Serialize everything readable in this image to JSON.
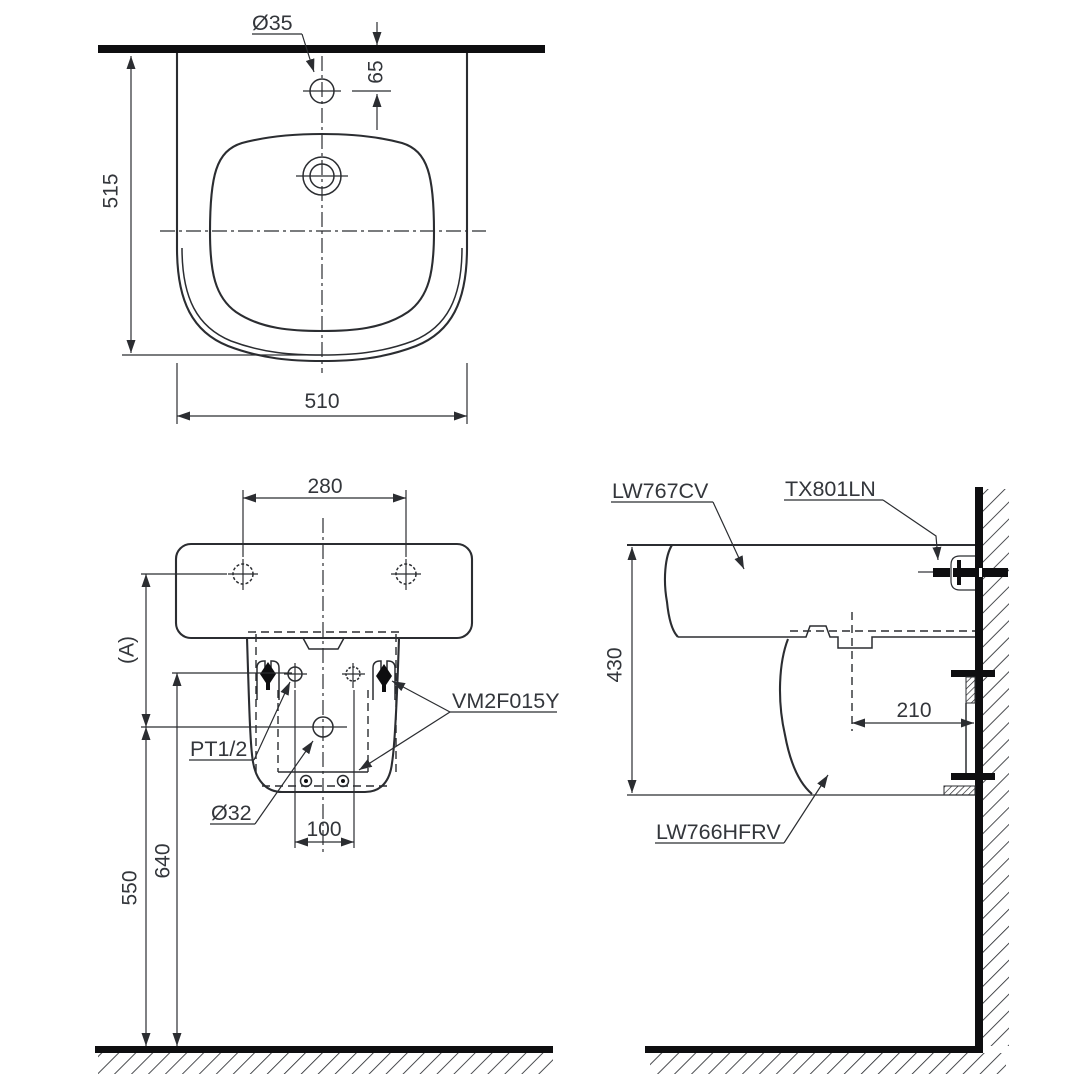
{
  "drawing": {
    "top_view": {
      "faucet_hole_dia": "Ø35",
      "hole_offset": "65",
      "depth": "515",
      "width": "510"
    },
    "front_view": {
      "bolt_spacing": "280",
      "ref_height": "(A)",
      "supply_thread": "PT1/2",
      "drain_dia": "Ø32",
      "supply_spacing": "100",
      "supply_height": "640",
      "drain_height": "550",
      "fixing_kit": "VM2F015Y"
    },
    "side_view": {
      "lavatory_model": "LW767CV",
      "stop_valve_model": "TX801LN",
      "height": "430",
      "drain_to_wall": "210",
      "shroud_model": "LW766HFRV"
    },
    "colors": {
      "line": "#2b2d31",
      "thick": "#0e0e10",
      "text": "#33363b",
      "background": "#ffffff"
    }
  }
}
